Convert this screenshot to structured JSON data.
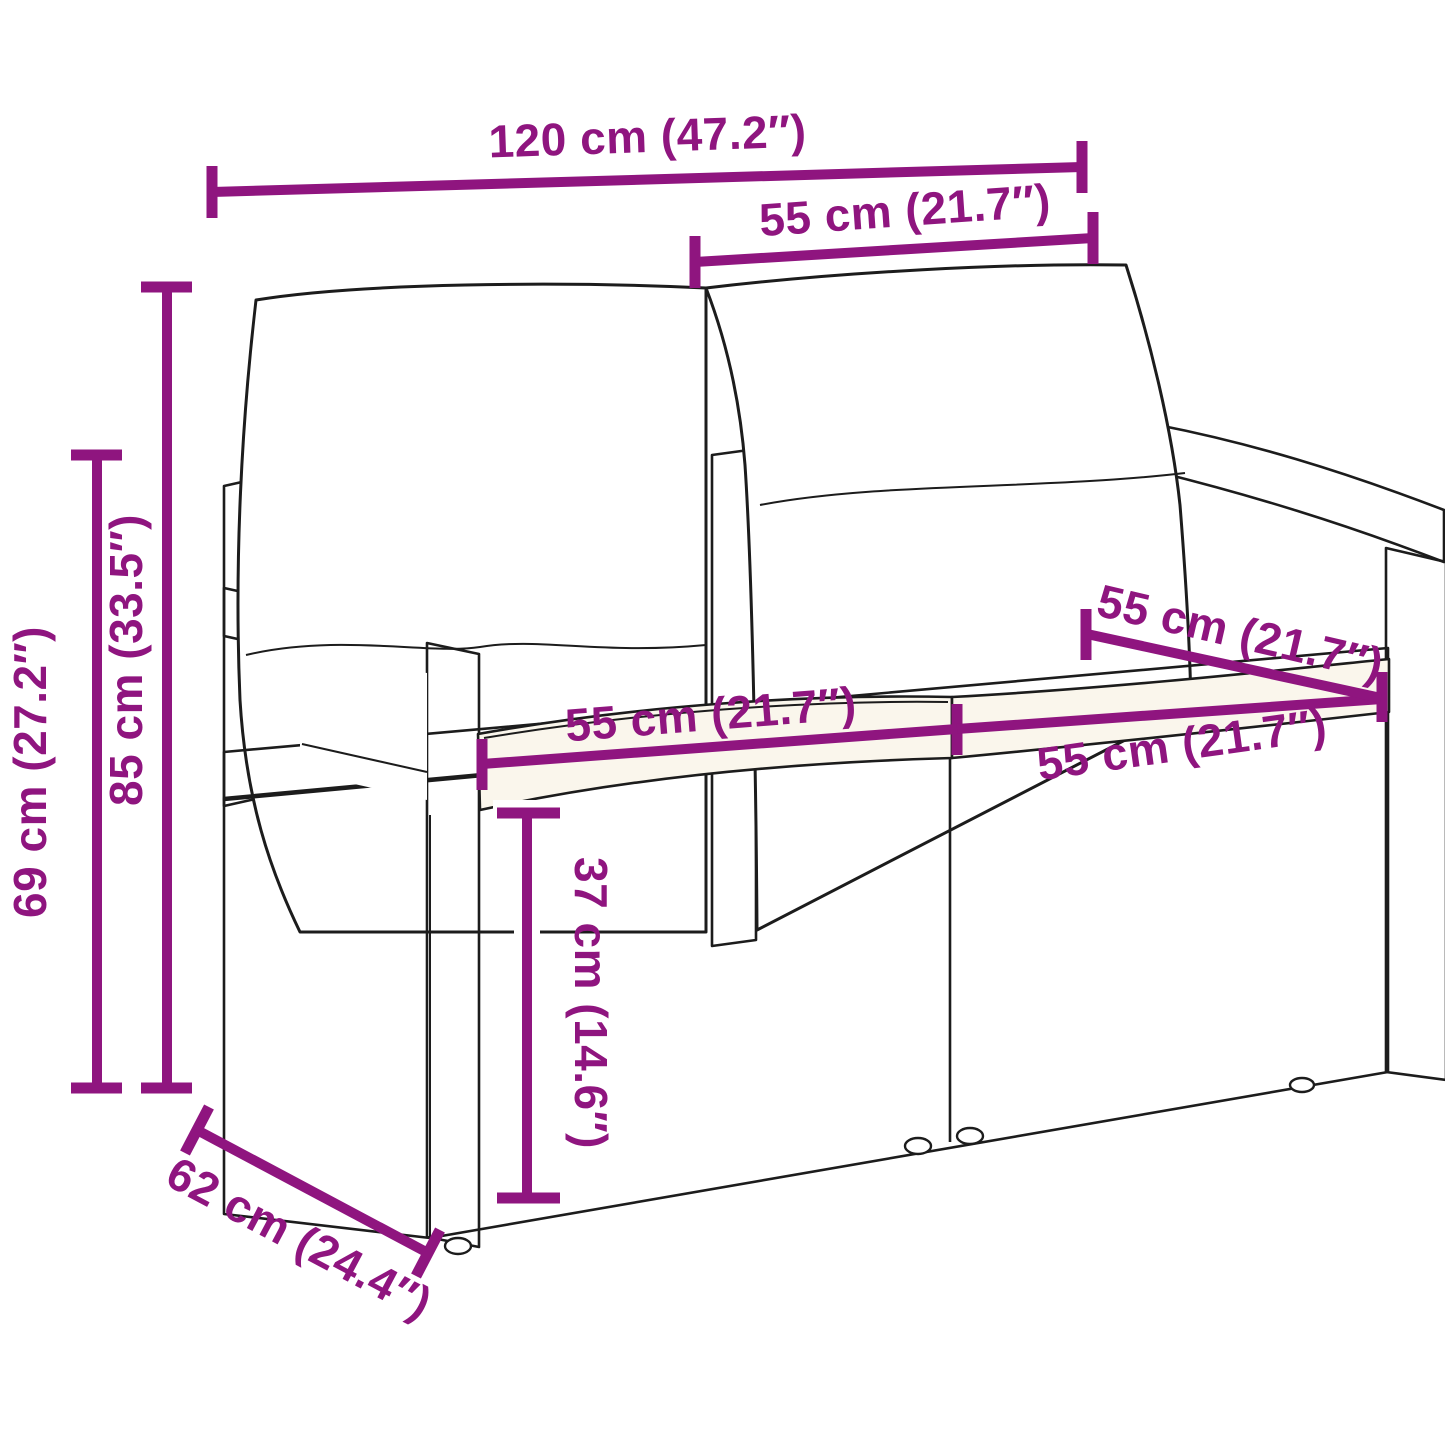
{
  "image": {
    "type": "product-dimension-diagram",
    "background": "#ffffff",
    "description": "Line-art drawing of a 2-seater poly rattan garden bench with back pillows and seat cushions, annotated with magenta dimension lines"
  },
  "product": {
    "subject": "2-seater rattan garden bench with cushions",
    "parts": [
      "left back pillow",
      "right back pillow",
      "left seat cushion",
      "right seat cushion",
      "left armrest",
      "right armrest",
      "wicker base",
      "feet"
    ]
  },
  "colors": {
    "dimension_accent": "#8f157f",
    "line_art": "#1c1c1c",
    "cushion_fill": "#faf6ec",
    "pillow_fill": "#ffffff"
  },
  "dimensions": {
    "overall_width": "120 cm (47.2″)",
    "back_cushion_width": "55 cm (21.7″)",
    "overall_height": "85 cm (33.5″)",
    "armrest_height": "69 cm (27.2″)",
    "seat_width_left": "55 cm (21.7″)",
    "seat_width_right": "55 cm (21.7″)",
    "seat_depth": "55 cm (21.7″)",
    "seat_height": "37 cm (14.6″)",
    "overall_depth": "62 cm (24.4″)"
  }
}
